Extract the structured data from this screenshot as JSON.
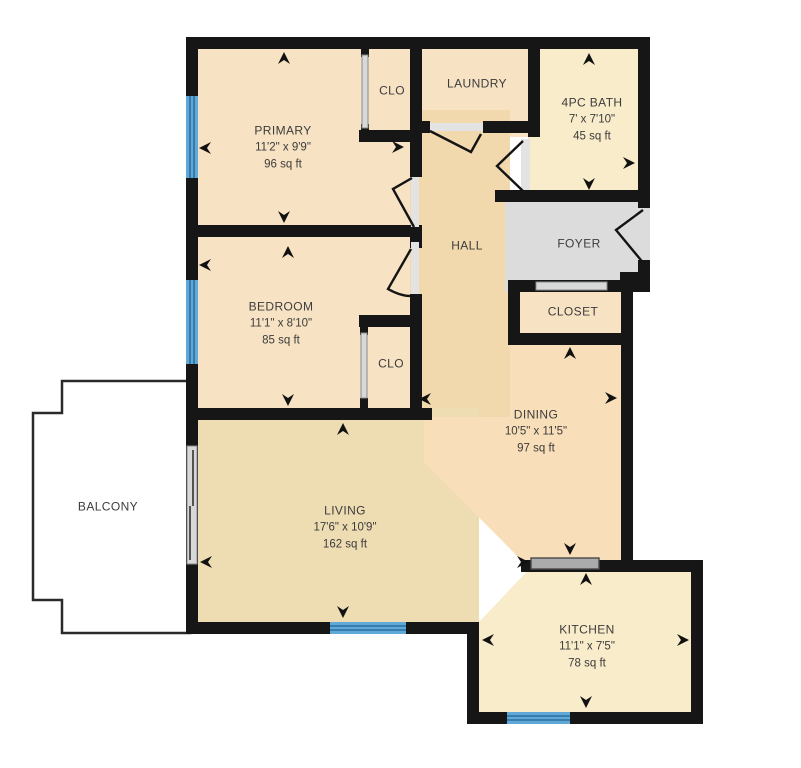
{
  "plan": {
    "title": "apartment-floor-plan",
    "rooms": [
      {
        "label": "PRIMARY",
        "dims": "11'2\" x 9'9\"",
        "area": "96 sq ft"
      },
      {
        "label": "CLO"
      },
      {
        "label": "LAUNDRY"
      },
      {
        "label": "4PC BATH",
        "dims": "7' x 7'10\"",
        "area": "45 sq ft"
      },
      {
        "label": "HALL"
      },
      {
        "label": "FOYER"
      },
      {
        "label": "CLOSET"
      },
      {
        "label": "BEDROOM",
        "dims": "11'1\" x 8'10\"",
        "area": "85 sq ft"
      },
      {
        "label": "CLO"
      },
      {
        "label": "DINING",
        "dims": "10'5\" x 11'5\"",
        "area": "97 sq ft"
      },
      {
        "label": "LIVING",
        "dims": "17'6\" x 10'9\"",
        "area": "162 sq ft"
      },
      {
        "label": "KITCHEN",
        "dims": "11'1\" x 7'5\"",
        "area": "78 sq ft"
      },
      {
        "label": "BALCONY"
      }
    ],
    "colors": {
      "wall": "#161616",
      "peach": "#f7e3c3",
      "cream": "#f9ecca",
      "hall": "#f1d9ad",
      "dining": "#f8dfb9",
      "living": "#eedcb3",
      "foyer": "#dcdcdc",
      "balcony": "#ffffff",
      "window": "#5fa8d7",
      "window_line": "#2d6f9e",
      "door_gray": "#d8d8d8",
      "slider_gray": "#ababab",
      "threshold_gray": "#e3e3e3",
      "text": "#3c3c3c"
    }
  }
}
